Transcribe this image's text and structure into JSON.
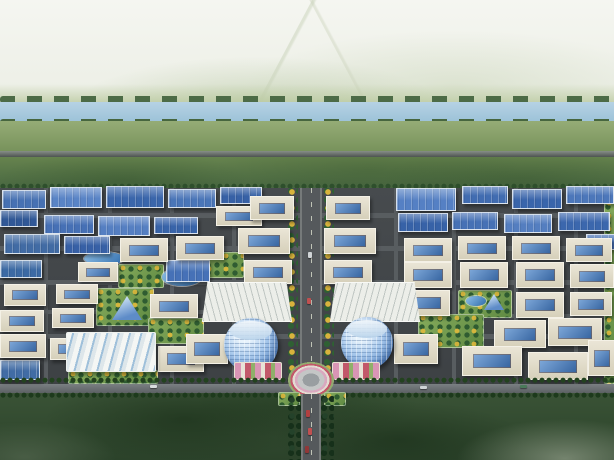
{
  "scene": {
    "alt": "Aerial architectural rendering of a planned industrial park: grid of blue-roofed factories and white courtyard offices, a central tree-lined boulevard with twin cylindrical glass towers and a circular flower plaza, a river and fields beyond, dark forest in the foreground",
    "width": 614,
    "height": 460
  },
  "palette": {
    "sky": "#eaede3",
    "river": "#a9c9dd",
    "meadow": "#85a068",
    "greenbelt": "#577547",
    "park_ground": "#42464a",
    "road": "#585d60",
    "factory_roof_blue": "#3a67b0",
    "office_wall": "#ded9c6",
    "courtyard_glass": "#4a7cc0",
    "tower_glass": "#9fc4e8",
    "garden_green": "#6f9a4e",
    "forest": "#31492f",
    "flower_pink": "#d9a8bf",
    "flower_red": "#c2586a"
  },
  "items": [
    {
      "k": "b",
      "n": "sky",
      "x": 0,
      "y": 0,
      "w": 614,
      "h": 120,
      "cls": "sky"
    },
    {
      "k": "b",
      "n": "distant-hills",
      "x": 0,
      "y": 84,
      "w": 614,
      "h": 24,
      "c": [
        "rgba(190,205,165,0)",
        "#b9c99e"
      ]
    },
    {
      "k": "da",
      "n": "river-treeline-north",
      "x": 0,
      "y": 96,
      "w": 614,
      "h": 7,
      "c": "#4c6b46"
    },
    {
      "k": "b",
      "n": "river",
      "x": 0,
      "y": 102,
      "w": 614,
      "h": 20,
      "c": [
        "#b6d2e4",
        "#9cc2d8"
      ]
    },
    {
      "k": "da",
      "n": "river-treeline-south",
      "x": 0,
      "y": 119,
      "w": 614,
      "h": 7,
      "c": "#47663f"
    },
    {
      "k": "b",
      "n": "meadow",
      "x": 0,
      "y": 121,
      "w": 614,
      "h": 34,
      "c": [
        "#95ac76",
        "#748f58"
      ]
    },
    {
      "k": "b",
      "n": "distant-highway",
      "x": 0,
      "y": 151,
      "w": 614,
      "h": 6,
      "c": [
        "#878e88",
        "#4e5451"
      ]
    },
    {
      "k": "b",
      "n": "greenbelt",
      "x": 0,
      "y": 157,
      "w": 614,
      "h": 32,
      "cls": "greenbelt"
    },
    {
      "k": "dt",
      "n": "park-north-hedge",
      "x": 0,
      "y": 183,
      "w": 614,
      "h": 6,
      "c": "#2e4f2c"
    },
    {
      "k": "b",
      "n": "park-ground",
      "x": 0,
      "y": 188,
      "w": 614,
      "h": 204,
      "c": [
        "#474b4e",
        "#3d4144"
      ]
    },
    {
      "k": "b",
      "n": "forest",
      "x": 0,
      "y": 392,
      "w": 614,
      "h": 68,
      "cls": "forest"
    },
    {
      "k": "r",
      "x": 0,
      "y": 213,
      "w": 614,
      "h": 5
    },
    {
      "k": "r",
      "x": 0,
      "y": 246,
      "w": 614,
      "h": 5
    },
    {
      "k": "r",
      "x": 0,
      "y": 280,
      "w": 614,
      "h": 5
    },
    {
      "k": "r",
      "x": 0,
      "y": 310,
      "w": 288,
      "h": 4
    },
    {
      "k": "r",
      "x": 392,
      "y": 314,
      "w": 222,
      "h": 4
    },
    {
      "k": "r",
      "x": 0,
      "y": 334,
      "w": 614,
      "h": 5
    },
    {
      "k": "r",
      "x": 44,
      "y": 188,
      "w": 4,
      "h": 196
    },
    {
      "k": "r",
      "x": 108,
      "y": 188,
      "w": 4,
      "h": 196
    },
    {
      "k": "r",
      "x": 170,
      "y": 188,
      "w": 4,
      "h": 196
    },
    {
      "k": "r",
      "x": 232,
      "y": 188,
      "w": 4,
      "h": 196
    },
    {
      "k": "r",
      "x": 394,
      "y": 188,
      "w": 4,
      "h": 196
    },
    {
      "k": "r",
      "x": 452,
      "y": 188,
      "w": 4,
      "h": 196
    },
    {
      "k": "r",
      "x": 514,
      "y": 188,
      "w": 4,
      "h": 196
    },
    {
      "k": "r",
      "x": 574,
      "y": 188,
      "w": 4,
      "h": 196
    },
    {
      "k": "r",
      "n": "main-east-west-road",
      "x": 0,
      "y": 384,
      "w": 614,
      "h": 9,
      "main": true
    },
    {
      "k": "tc",
      "n": "boulevard-trees-west",
      "x": 288,
      "y": 188,
      "w": 10,
      "h": 192
    },
    {
      "k": "bl",
      "n": "central-boulevard",
      "x": 300,
      "y": 188,
      "w": 22,
      "h": 196
    },
    {
      "k": "tc",
      "n": "boulevard-trees-east",
      "x": 324,
      "y": 188,
      "w": 10,
      "h": 192
    },
    {
      "k": "g",
      "x": 604,
      "y": 186,
      "w": 10,
      "h": 196
    },
    {
      "k": "g",
      "x": 118,
      "y": 264,
      "w": 44,
      "h": 22
    },
    {
      "k": "g",
      "x": 96,
      "y": 288,
      "w": 56,
      "h": 36
    },
    {
      "k": "g",
      "x": 148,
      "y": 318,
      "w": 54,
      "h": 24
    },
    {
      "k": "g",
      "x": 204,
      "y": 252,
      "w": 38,
      "h": 24
    },
    {
      "k": "g",
      "x": 458,
      "y": 290,
      "w": 52,
      "h": 26
    },
    {
      "k": "g",
      "x": 418,
      "y": 314,
      "w": 64,
      "h": 32
    },
    {
      "k": "g",
      "x": 68,
      "y": 370,
      "w": 88,
      "h": 12
    },
    {
      "k": "p",
      "x": 162,
      "y": 268,
      "w": 40,
      "h": 18
    },
    {
      "k": "p",
      "x": 84,
      "y": 252,
      "w": 40,
      "h": 13
    },
    {
      "k": "p",
      "x": 466,
      "y": 296,
      "w": 20,
      "h": 10
    },
    {
      "k": "py",
      "x": 112,
      "y": 296,
      "w": 30,
      "h": 24
    },
    {
      "k": "py",
      "x": 484,
      "y": 294,
      "w": 20,
      "h": 16
    },
    {
      "k": "f",
      "x": 2,
      "y": 190,
      "w": 42,
      "h": 17,
      "c": "#3a68ae"
    },
    {
      "k": "f",
      "x": 50,
      "y": 187,
      "w": 50,
      "h": 19,
      "c": "#4f7cc2"
    },
    {
      "k": "f",
      "x": 106,
      "y": 186,
      "w": 56,
      "h": 20,
      "c": "#2e5ca6"
    },
    {
      "k": "f",
      "x": 168,
      "y": 189,
      "w": 46,
      "h": 17,
      "c": "#3f6db4"
    },
    {
      "k": "f",
      "x": 220,
      "y": 187,
      "w": 40,
      "h": 15,
      "c": "#2a57a0"
    },
    {
      "k": "f",
      "x": 0,
      "y": 210,
      "w": 36,
      "h": 15,
      "c": "#244e90"
    },
    {
      "k": "f",
      "x": 44,
      "y": 215,
      "w": 48,
      "h": 17,
      "c": "#3a67b0"
    },
    {
      "k": "f",
      "x": 98,
      "y": 216,
      "w": 50,
      "h": 18,
      "c": "#4a77be"
    },
    {
      "k": "f",
      "x": 154,
      "y": 217,
      "w": 42,
      "h": 15,
      "c": "#2c5aa4"
    },
    {
      "k": "f",
      "x": 4,
      "y": 234,
      "w": 54,
      "h": 18,
      "c": "#35629e"
    },
    {
      "k": "f",
      "x": 64,
      "y": 236,
      "w": 44,
      "h": 16,
      "c": "#2a56a0"
    },
    {
      "k": "f",
      "x": 0,
      "y": 260,
      "w": 40,
      "h": 16,
      "c": "#30619e"
    },
    {
      "k": "f",
      "x": 166,
      "y": 260,
      "w": 42,
      "h": 20,
      "c": "#3a68b2"
    },
    {
      "k": "f",
      "x": 396,
      "y": 188,
      "w": 58,
      "h": 21,
      "c": "#4a78c0"
    },
    {
      "k": "f",
      "x": 462,
      "y": 186,
      "w": 44,
      "h": 16,
      "c": "#3563ac"
    },
    {
      "k": "f",
      "x": 512,
      "y": 189,
      "w": 48,
      "h": 18,
      "c": "#2d5ba6"
    },
    {
      "k": "f",
      "x": 566,
      "y": 186,
      "w": 46,
      "h": 16,
      "c": "#416fb6"
    },
    {
      "k": "f",
      "x": 398,
      "y": 213,
      "w": 48,
      "h": 17,
      "c": "#2a58a2"
    },
    {
      "k": "f",
      "x": 452,
      "y": 212,
      "w": 44,
      "h": 16,
      "c": "#3a68b0"
    },
    {
      "k": "f",
      "x": 504,
      "y": 214,
      "w": 46,
      "h": 17,
      "c": "#4976bc"
    },
    {
      "k": "f",
      "x": 558,
      "y": 212,
      "w": 50,
      "h": 17,
      "c": "#2f5da8"
    },
    {
      "k": "f",
      "x": 586,
      "y": 234,
      "w": 28,
      "h": 14,
      "c": "#3a66ae"
    },
    {
      "k": "f",
      "x": 0,
      "y": 360,
      "w": 38,
      "h": 18,
      "c": "#35639f"
    },
    {
      "k": "o",
      "x": 216,
      "y": 206,
      "w": 44,
      "h": 18
    },
    {
      "k": "o",
      "x": 250,
      "y": 196,
      "w": 42,
      "h": 22
    },
    {
      "k": "o",
      "x": 326,
      "y": 196,
      "w": 42,
      "h": 22
    },
    {
      "k": "o",
      "x": 238,
      "y": 228,
      "w": 50,
      "h": 24
    },
    {
      "k": "o",
      "x": 324,
      "y": 228,
      "w": 50,
      "h": 24
    },
    {
      "k": "o",
      "x": 244,
      "y": 260,
      "w": 46,
      "h": 22
    },
    {
      "k": "o",
      "x": 324,
      "y": 260,
      "w": 46,
      "h": 22
    },
    {
      "k": "o",
      "x": 120,
      "y": 238,
      "w": 46,
      "h": 22
    },
    {
      "k": "o",
      "x": 176,
      "y": 236,
      "w": 46,
      "h": 22
    },
    {
      "k": "o",
      "x": 78,
      "y": 262,
      "w": 38,
      "h": 18
    },
    {
      "k": "o",
      "x": 4,
      "y": 284,
      "w": 40,
      "h": 20
    },
    {
      "k": "o",
      "x": 56,
      "y": 284,
      "w": 40,
      "h": 18
    },
    {
      "k": "o",
      "x": 0,
      "y": 310,
      "w": 42,
      "h": 20
    },
    {
      "k": "o",
      "x": 52,
      "y": 308,
      "w": 40,
      "h": 18
    },
    {
      "k": "o",
      "x": 150,
      "y": 294,
      "w": 46,
      "h": 22
    },
    {
      "k": "o",
      "x": 404,
      "y": 238,
      "w": 46,
      "h": 22
    },
    {
      "k": "o",
      "x": 458,
      "y": 236,
      "w": 46,
      "h": 22
    },
    {
      "k": "o",
      "x": 512,
      "y": 236,
      "w": 46,
      "h": 22
    },
    {
      "k": "o",
      "x": 566,
      "y": 238,
      "w": 44,
      "h": 22
    },
    {
      "k": "o",
      "x": 404,
      "y": 262,
      "w": 46,
      "h": 24
    },
    {
      "k": "o",
      "x": 460,
      "y": 262,
      "w": 46,
      "h": 24
    },
    {
      "k": "o",
      "x": 516,
      "y": 262,
      "w": 46,
      "h": 24
    },
    {
      "k": "o",
      "x": 570,
      "y": 264,
      "w": 42,
      "h": 22
    },
    {
      "k": "o",
      "x": 402,
      "y": 290,
      "w": 46,
      "h": 24
    },
    {
      "k": "o",
      "x": 516,
      "y": 292,
      "w": 46,
      "h": 24
    },
    {
      "k": "o",
      "x": 570,
      "y": 292,
      "w": 40,
      "h": 22
    },
    {
      "k": "o",
      "x": 494,
      "y": 320,
      "w": 50,
      "h": 26
    },
    {
      "k": "o",
      "x": 548,
      "y": 318,
      "w": 52,
      "h": 26
    },
    {
      "k": "o",
      "x": 462,
      "y": 346,
      "w": 58,
      "h": 28
    },
    {
      "k": "o",
      "x": 528,
      "y": 352,
      "w": 58,
      "h": 26
    },
    {
      "k": "o",
      "x": 588,
      "y": 340,
      "w": 26,
      "h": 34
    },
    {
      "k": "o",
      "x": 0,
      "y": 334,
      "w": 44,
      "h": 22
    },
    {
      "k": "o",
      "x": 50,
      "y": 338,
      "w": 40,
      "h": 20
    },
    {
      "k": "o",
      "x": 158,
      "y": 346,
      "w": 44,
      "h": 24
    },
    {
      "k": "o",
      "x": 186,
      "y": 334,
      "w": 40,
      "h": 28
    },
    {
      "k": "o",
      "x": 394,
      "y": 334,
      "w": 42,
      "h": 28
    },
    {
      "k": "hl",
      "n": "exhibition-hall",
      "x": 66,
      "y": 332,
      "w": 88,
      "h": 38
    },
    {
      "k": "fa",
      "x": 202,
      "y": 282,
      "w": 88,
      "h": 38,
      "a": "75deg"
    },
    {
      "k": "fa",
      "x": 330,
      "y": 282,
      "w": 88,
      "h": 38,
      "a": "105deg"
    },
    {
      "k": "t",
      "n": "glass-tower-west",
      "x": 224,
      "y": 318,
      "w": 54,
      "h": 54
    },
    {
      "k": "t",
      "n": "glass-tower-east",
      "x": 341,
      "y": 317,
      "w": 52,
      "h": 52
    },
    {
      "k": "fl",
      "x": 234,
      "y": 362,
      "w": 46,
      "h": 16
    },
    {
      "k": "fl",
      "x": 332,
      "y": 362,
      "w": 46,
      "h": 16
    },
    {
      "k": "dt",
      "n": "street-trees-north",
      "x": 0,
      "y": 377,
      "w": 614,
      "h": 7,
      "c": "#23421f"
    },
    {
      "k": "dt",
      "n": "street-trees-south",
      "x": 0,
      "y": 392,
      "w": 614,
      "h": 6,
      "c": "#1d3a1c"
    },
    {
      "k": "z",
      "n": "central-flower-plaza",
      "x": 283,
      "y": 358,
      "w": 56,
      "h": 44
    },
    {
      "k": "g",
      "x": 278,
      "y": 392,
      "w": 20,
      "h": 12
    },
    {
      "k": "g",
      "x": 324,
      "y": 392,
      "w": 20,
      "h": 12
    },
    {
      "k": "tc",
      "n": "forest-road-trees-west",
      "x": 288,
      "y": 396,
      "w": 13,
      "h": 64,
      "t1": "#16301a",
      "t2": "#24422a"
    },
    {
      "k": "tc",
      "n": "forest-road-trees-east",
      "x": 321,
      "y": 396,
      "w": 13,
      "h": 64,
      "t1": "#16301a",
      "t2": "#24422a"
    },
    {
      "k": "bl",
      "n": "south-approach-road",
      "x": 301,
      "y": 394,
      "w": 20,
      "h": 66
    },
    {
      "k": "car",
      "x": 306,
      "y": 410,
      "w": 4,
      "h": 7,
      "c": "#b04040"
    },
    {
      "k": "car",
      "x": 308,
      "y": 428,
      "w": 4,
      "h": 7,
      "c": "#c05050"
    },
    {
      "k": "car",
      "x": 305,
      "y": 446,
      "w": 4,
      "h": 7,
      "c": "#903838"
    },
    {
      "k": "car",
      "x": 150,
      "y": 385,
      "w": 7,
      "h": 3,
      "c": "#d8dcde"
    },
    {
      "k": "car",
      "x": 420,
      "y": 386,
      "w": 7,
      "h": 3,
      "c": "#cfd4d6"
    },
    {
      "k": "car",
      "x": 520,
      "y": 385,
      "w": 7,
      "h": 3,
      "c": "#4a7a5a"
    },
    {
      "k": "car",
      "x": 308,
      "y": 252,
      "w": 4,
      "h": 6,
      "c": "#d0d4d6"
    },
    {
      "k": "car",
      "x": 307,
      "y": 298,
      "w": 4,
      "h": 6,
      "c": "#c05050"
    }
  ]
}
